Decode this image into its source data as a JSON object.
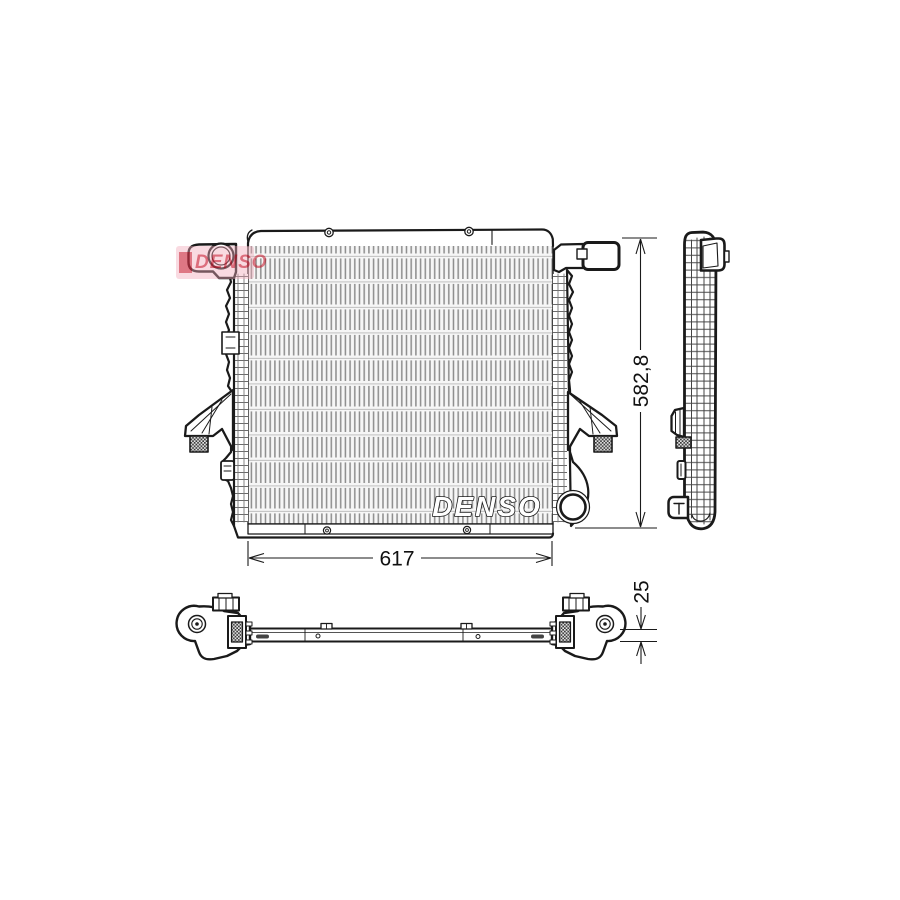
{
  "branding": {
    "logo_text": "DENSO",
    "core_watermark_text": "DENSO"
  },
  "dimensions": {
    "height_label": "582,8",
    "width_label": "617",
    "depth_label": "25"
  },
  "colors": {
    "background": "#ffffff",
    "line": "#1a1a1a",
    "hatch_gray": "#8d8d8d",
    "logo_red": "#c00016",
    "logo_pink": "#f2aab9"
  }
}
